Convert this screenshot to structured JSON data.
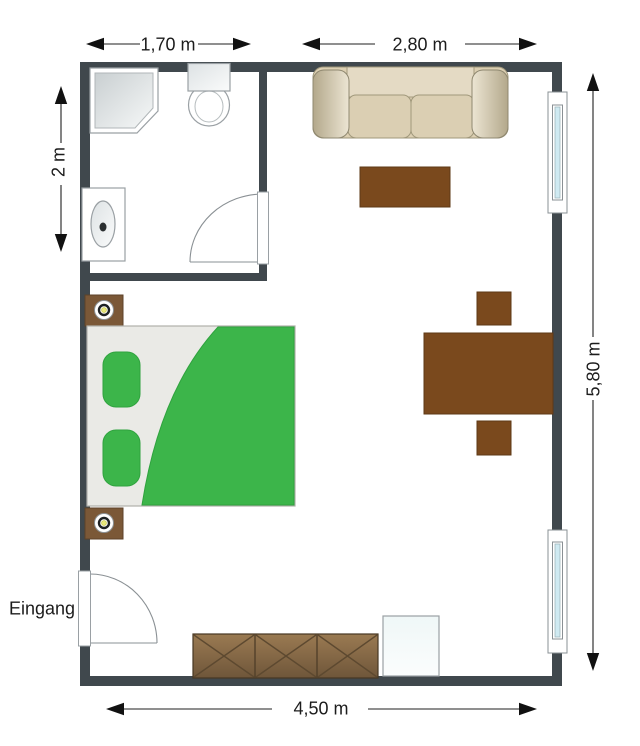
{
  "plan": {
    "type": "apartment-floor-plan",
    "rooms": [
      "bathroom",
      "living-bedroom"
    ],
    "labels": {
      "entrance": "Eingang"
    },
    "dimensions": {
      "bath_width": "1,70 m",
      "living_width": "2,80 m",
      "bath_depth": "2 m",
      "room_depth": "5,80 m",
      "room_width": "4,50 m"
    },
    "furniture": [
      "shower",
      "toilet",
      "sink",
      "bathroom-door",
      "entrance-door",
      "sofa",
      "coffee-table",
      "dining-table",
      "chair-top",
      "chair-bottom",
      "bed",
      "pillow-1",
      "pillow-2",
      "nightstand-1",
      "nightstand-2",
      "lamp-1",
      "lamp-2",
      "sideboard",
      "appliance-box",
      "window-1",
      "window-2"
    ],
    "colors": {
      "wall": "#40484d",
      "wood": "#7a491d",
      "wood_stroke": "#5e3916",
      "sideboard_line": "#5d4930",
      "sideboard_stroke": "#463723",
      "nightstand": "#7b5837",
      "nightstand_stroke": "#5d4228",
      "bed_sheet": "#eaeae6",
      "bed_green": "#3cb54a",
      "green_stroke": "#2fa23e",
      "glass": "#cfeaf2",
      "dimension": "#1f1f1f"
    }
  }
}
